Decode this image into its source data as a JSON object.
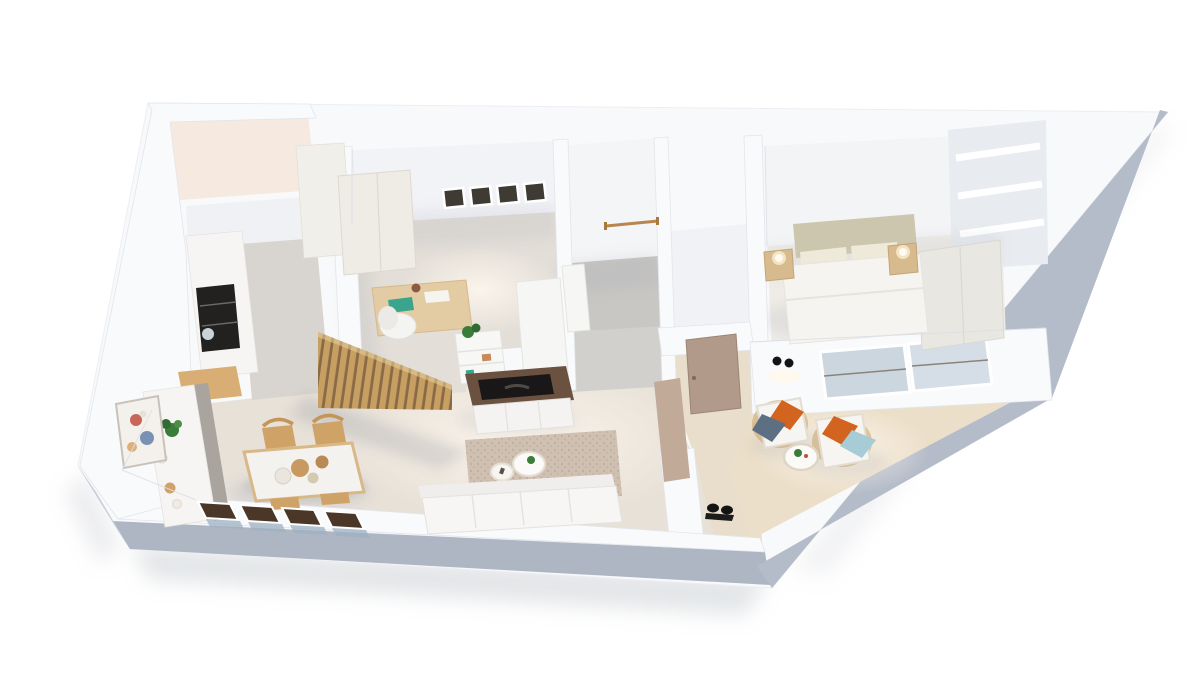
{
  "scene": {
    "description": "3D isometric architectural render of a one-bedroom apartment floor plan, viewed from above at an angle, white walls on a white background",
    "render_style": "photorealistic dollhouse / cutaway floor plan",
    "background_color": "#ffffff"
  },
  "palette": {
    "wall_top": "#f8f9fb",
    "wall_face_lit": "#f1f2f5",
    "wall_face_shadow": "#aeb6c4",
    "wall_face_shadow_light": "#c6cdd8",
    "floor_warm": "#e7e1d8",
    "floor_tile_gray": "#c9c7c4",
    "floor_wood_hall": "#e9decb",
    "floor_bedroom": "#efece7",
    "floor_utility_peach": "#f6e9df",
    "marble_counter": "#f6f5f3",
    "counter_shade": "#a9a49d",
    "wood_light": "#d9b887",
    "wood_slat": "#c79f63",
    "wood_slat_gap": "#8a6a44",
    "wood_walnut": "#6a5140",
    "appliance_black": "#232120",
    "tv_black": "#191717",
    "door_taupe": "#b29a8a",
    "window_dark": "#4a3728",
    "glass_blue": "#ccd6df",
    "rug_beige": "#cfc0b1",
    "sofa_white": "#f7f6f4",
    "bed_headboard": "#cdc6ae",
    "bed_linen": "#f6f4f0",
    "pillow_orange": "#d3641f",
    "pillow_blue_gray": "#5d7083",
    "pillow_sky": "#a7ccd6",
    "plant_green": "#3a7d3a",
    "lamp_glow": "#f2e3c2"
  },
  "rooms": {
    "utility": {
      "label": "Utility room (top-left, enclosed)",
      "furniture": [
        "empty warm-lit floor"
      ]
    },
    "kitchen": {
      "label": "Galley kitchen",
      "furniture": [
        "marble counter with built-in black oven column",
        "tall cream cabinet run",
        "wood cutting board",
        "glass vase",
        "lower marble counter with plant and bowls"
      ]
    },
    "dining": {
      "label": "Dining area",
      "furniture": [
        "white dining table with wood trim",
        "four wood chairs",
        "serving bowls",
        "wall artwork",
        "potted plant",
        "four low dark-framed windows in bottom wall"
      ]
    },
    "living": {
      "label": "Living room",
      "furniture": [
        "wood slat partition screen",
        "white shelf unit with plant",
        "walnut TV console with flat TV",
        "beige textured rug",
        "two round white coffee tables",
        "white sofa along bottom wall",
        "black wall spotlight"
      ]
    },
    "office": {
      "label": "Home office",
      "furniture": [
        "four small square windows",
        "cream wardrobe",
        "wood desk with papers and teal notebook",
        "white desk chair",
        "desk lamp",
        "white storage unit with wood drawers"
      ]
    },
    "bathroom": {
      "label": "Bathroom",
      "furniture": [
        "gray tile floor",
        "wood towel rail",
        "white vanity"
      ]
    },
    "hallway": {
      "label": "Entrance hallway",
      "furniture": [
        "taupe entrance door",
        "taupe accent wall",
        "black ceiling spotlight"
      ]
    },
    "bedroom": {
      "label": "Bedroom",
      "furniture": [
        "double bed with beige headboard and white duvet",
        "two wood nightstands with round lamps",
        "built-in closet niches",
        "wardrobe panel",
        "glazed sliding door to terrace"
      ]
    },
    "terrace": {
      "label": "Terrace lounge (diagonal corner)",
      "furniture": [
        "two rattan armchairs with white cushions and orange and blue pillows",
        "round white coffee table with plant",
        "black wall spotlight"
      ]
    }
  }
}
